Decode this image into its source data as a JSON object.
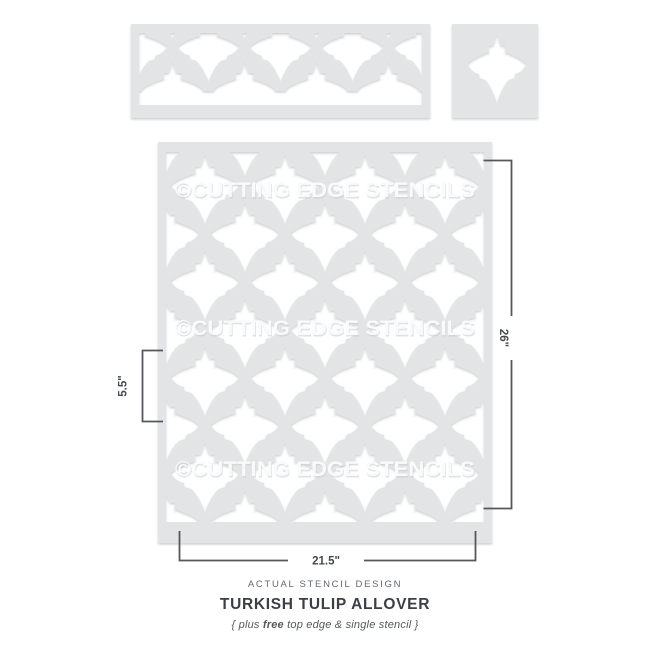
{
  "watermark": {
    "text": "©CUTTING EDGE STENCILS"
  },
  "dimensions": {
    "height": "26\"",
    "motif": "5.5\"",
    "width": "21.5\""
  },
  "caption": {
    "kicker": "ACTUAL STENCIL DESIGN",
    "title": "TURKISH TULIP ALLOVER",
    "note_pre": "{ plus ",
    "note_bold": "free",
    "note_post": " top edge & single stencil }"
  },
  "colors": {
    "sheet": "#e3e4e6",
    "cutout": "#ffffff",
    "line": "#54585c",
    "dim_text": "#45494e",
    "watermark": "#f9fafb",
    "watermark_shadow": "#c6c9cc",
    "kicker": "#64696e",
    "title": "#3b4045",
    "note": "#54585c"
  }
}
